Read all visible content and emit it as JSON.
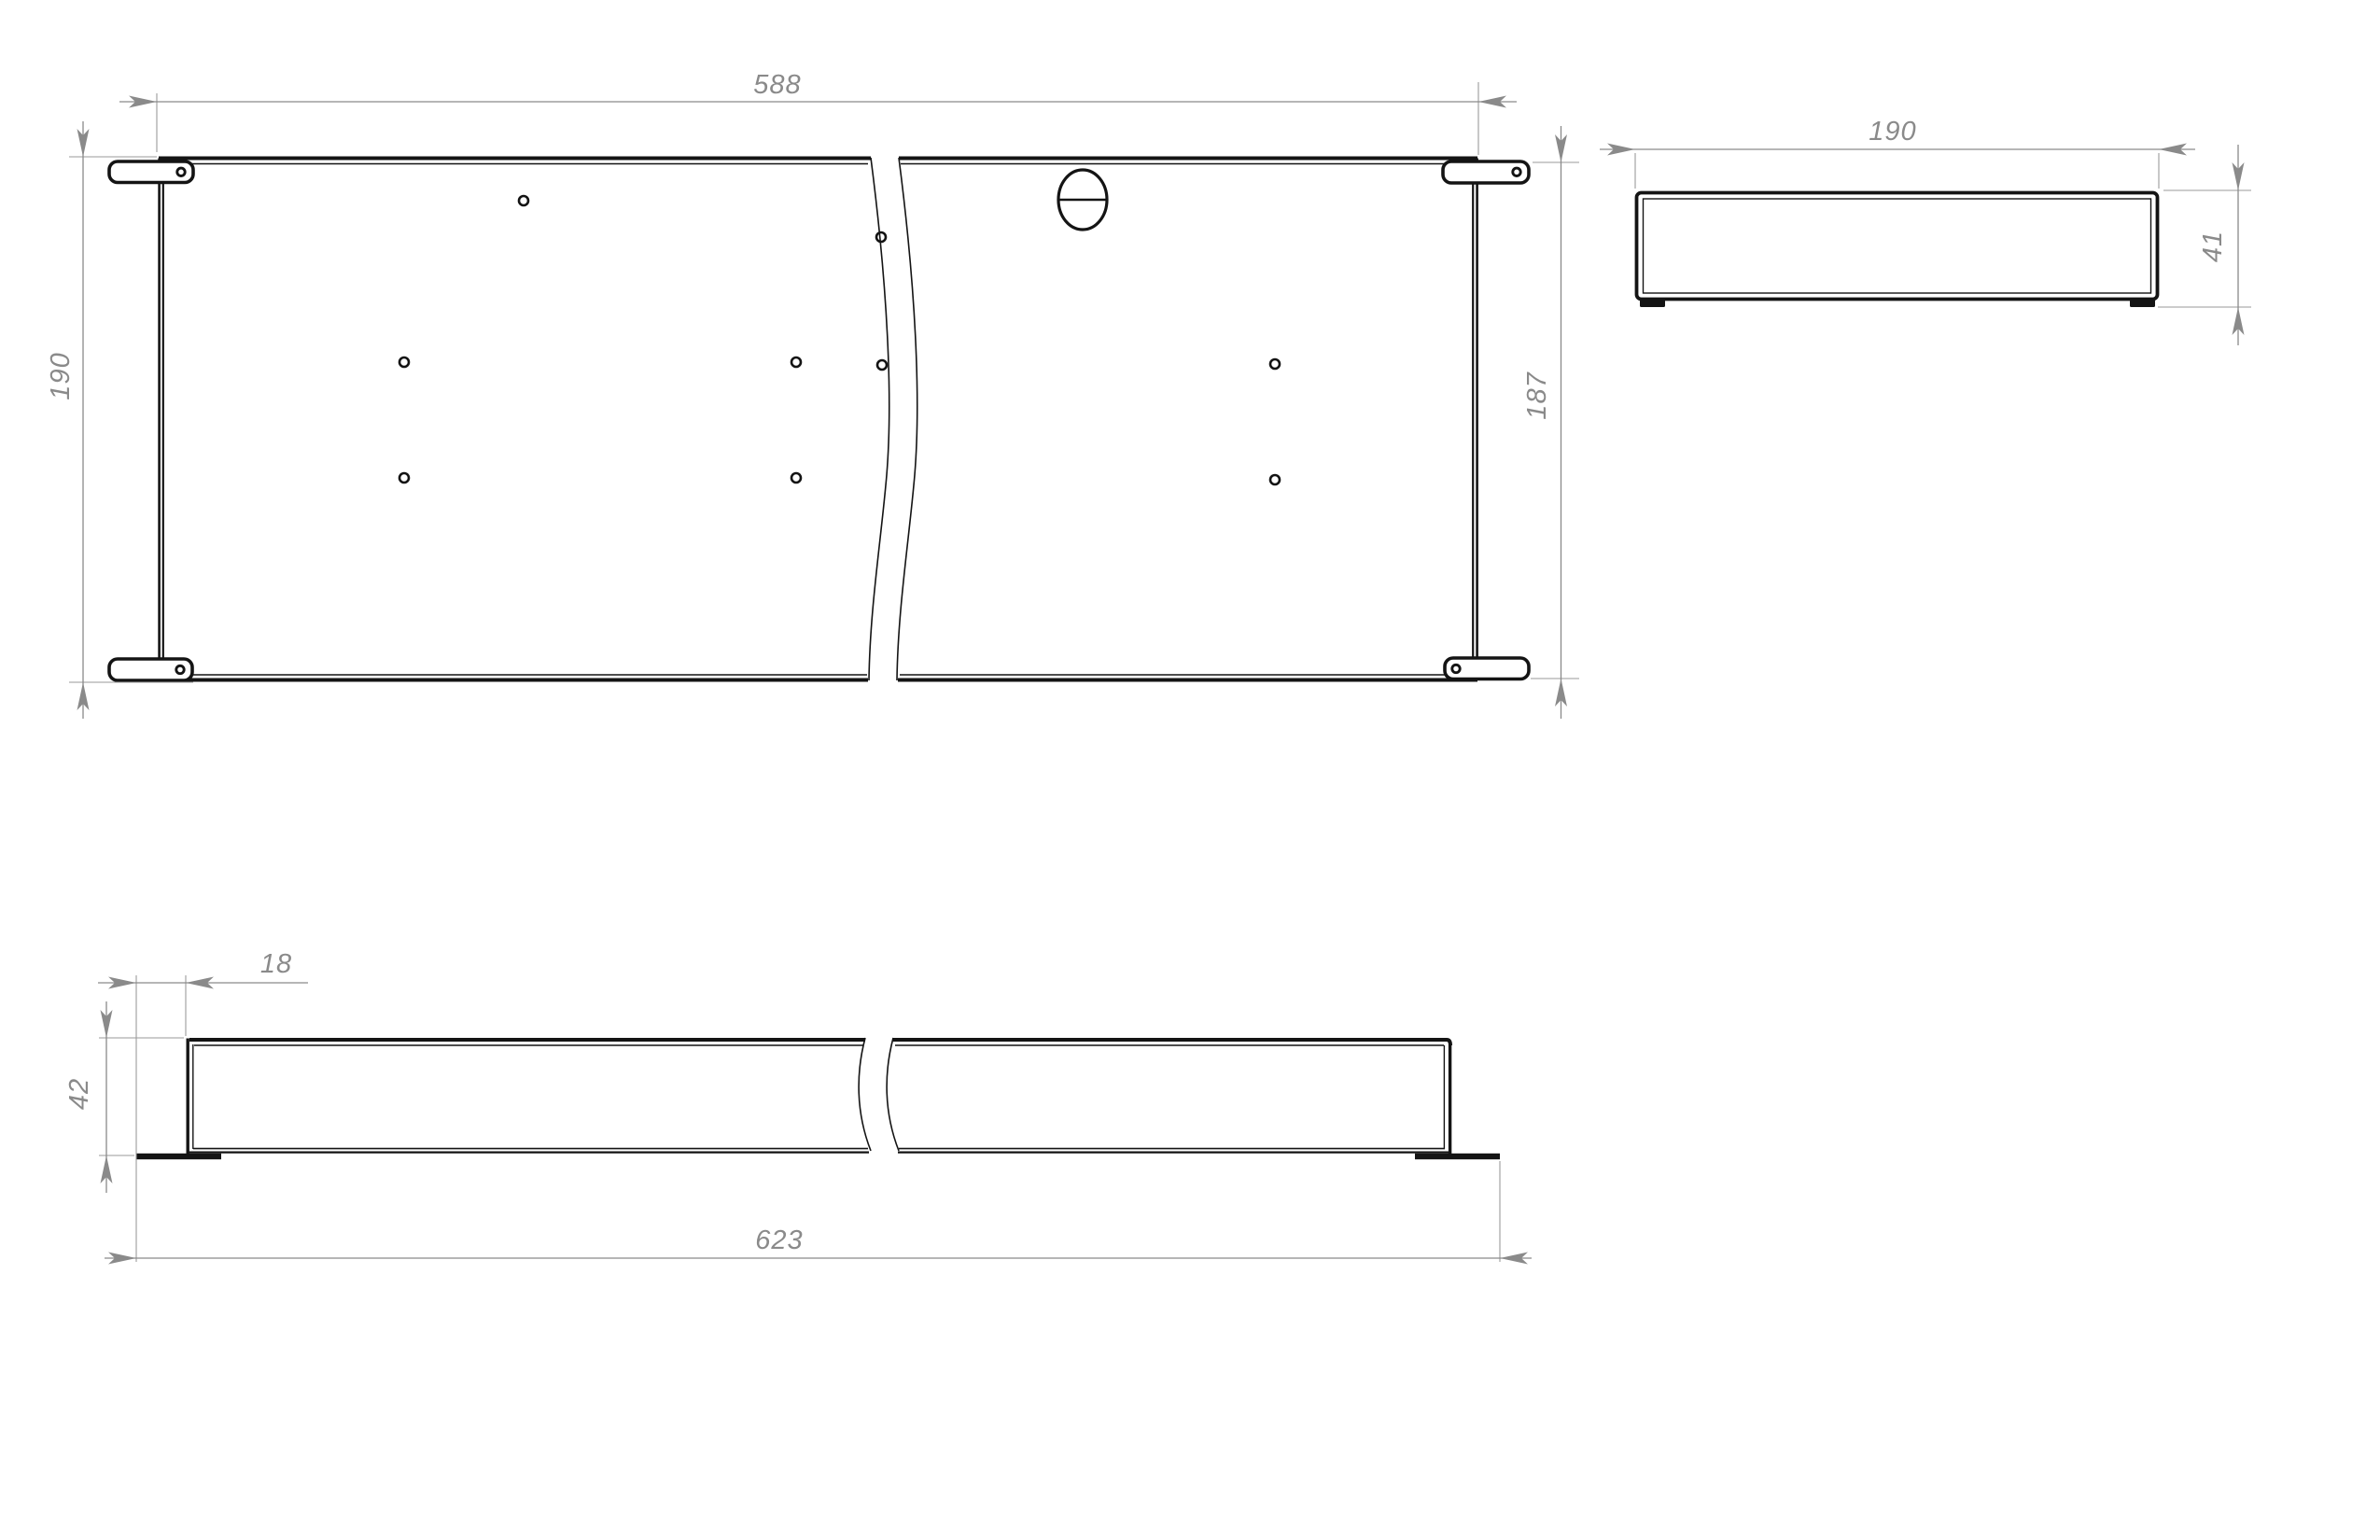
{
  "drawing": {
    "type": "engineering-drawing",
    "part": "sheet-metal-tray",
    "colors": {
      "background": "#ffffff",
      "line": "#141414",
      "dimension": "#8a8a8a"
    },
    "views": {
      "top": {
        "label": "top-view",
        "dim_length": "588",
        "dim_width_left": "190",
        "dim_width_right": "187"
      },
      "side": {
        "label": "side-view",
        "dim_width": "190",
        "dim_height": "41"
      },
      "front": {
        "label": "front-view",
        "dim_flange_offset": "18",
        "dim_height": "42",
        "dim_overall_length": "623"
      }
    }
  }
}
